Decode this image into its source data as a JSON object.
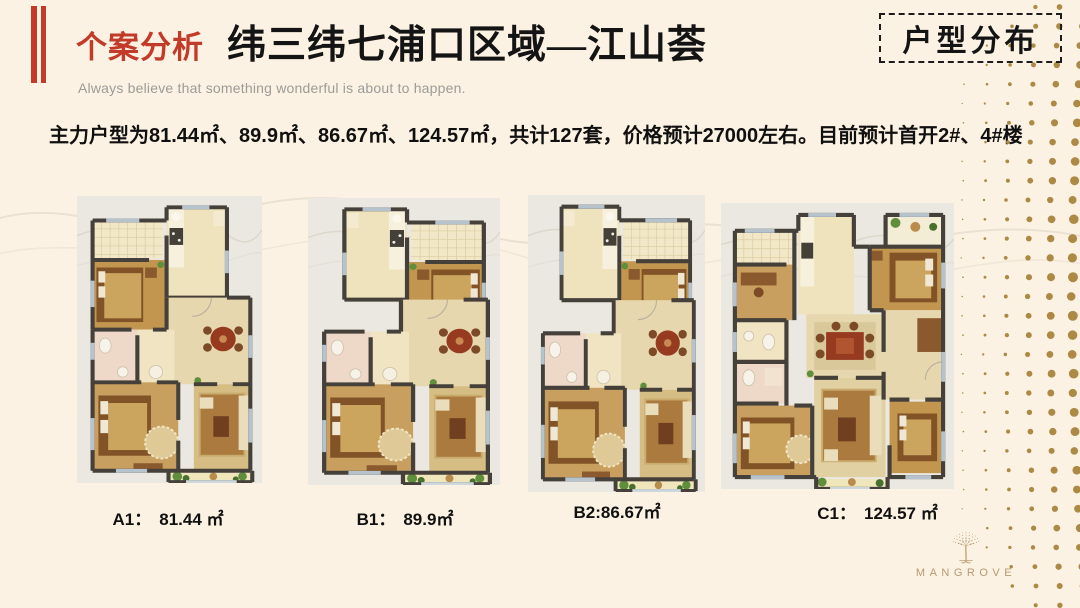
{
  "header": {
    "eyebrow": "个案分析",
    "title": "纬三纬七浦口区域—江山荟",
    "subtitle": "Always believe that something wonderful is about to happen.",
    "corner_tag": "户型分布"
  },
  "summary": "主力户型为81.44㎡、89.9㎡、86.67㎡、124.57㎡，共计127套，价格预计27000左右。目前预计首开2#、4#楼",
  "floor_plans": [
    {
      "id": "A1",
      "separator": "：",
      "area": "81.44 ㎡"
    },
    {
      "id": "B1",
      "separator": "：",
      "area": "89.9㎡"
    },
    {
      "id": "B2",
      "separator": ":",
      "area": "86.67㎡"
    },
    {
      "id": "C1",
      "separator": "：",
      "area": "124.57 ㎡"
    }
  ],
  "logo": {
    "icon": "mangrove-tree-icon",
    "text": "MANGROVE"
  },
  "colors": {
    "slide_bg": "#fcf2e3",
    "accent_red": "#c23a28",
    "gold_dots": "#ac8a45",
    "logo_gold": "#b59a6e",
    "plan_bg": "#ebe8e1",
    "wall": "#45413a"
  }
}
